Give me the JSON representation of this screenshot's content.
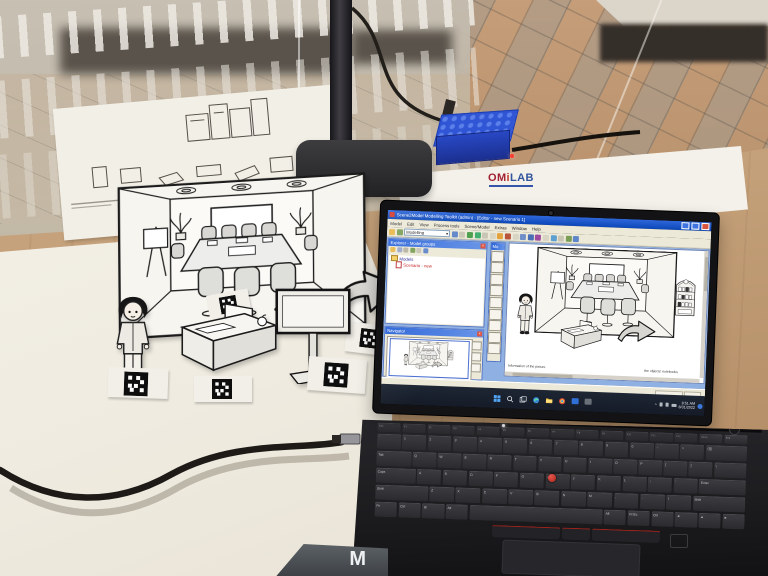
{
  "app": {
    "title": "Scene2Model Modelling Toolkit (admin) - [Editor - new Scenario 1]",
    "menus": [
      "Model",
      "Edit",
      "View",
      "Process tools",
      "Scene/Model",
      "Extras",
      "Window",
      "Help"
    ],
    "toolbar": {
      "mode_label": "Modelling",
      "mode_arrow": "▾"
    },
    "explorer": {
      "title": "Explorer - Model groups",
      "folder": "Models",
      "item": "Scenario - new",
      "close": "x"
    },
    "palette": {
      "title": "Mo"
    },
    "navigator": {
      "title": "Navigator",
      "close": "x"
    },
    "canvas": {
      "caption_left": "Information of the picture",
      "caption_right": "the objects' notebooks"
    }
  },
  "taskbar": {
    "time": "8:51 AM",
    "date": "8/31/2022"
  },
  "desk": {
    "omilab": {
      "part1": "OM",
      "part2": "i",
      "part3": "LAB"
    },
    "bottom_object_letter": "M"
  },
  "keyboard": {
    "row_fn": [
      "Esc",
      "F1",
      "F2",
      "F3",
      "F4",
      "F5",
      "F6",
      "F7",
      "F8",
      "F9",
      "F10",
      "F11",
      "F12",
      "Home",
      "End"
    ],
    "row_num": [
      "`",
      "1",
      "2",
      "3",
      "4",
      "5",
      "6",
      "7",
      "8",
      "9",
      "0",
      "-",
      "=",
      "⌫"
    ],
    "row_q": [
      "Tab",
      "Q",
      "W",
      "E",
      "R",
      "T",
      "Y",
      "U",
      "I",
      "O",
      "P",
      "[",
      "]",
      "\\"
    ],
    "row_a": [
      "Caps",
      "A",
      "S",
      "D",
      "F",
      "G",
      "H",
      "J",
      "K",
      "L",
      ";",
      "'",
      "Enter"
    ],
    "row_z": [
      "Shift",
      "Z",
      "X",
      "C",
      "V",
      "B",
      "N",
      "M",
      ",",
      ".",
      "/",
      "Shift"
    ],
    "row_space": [
      "Fn",
      "Ctrl",
      "⊞",
      "Alt",
      "",
      "Alt",
      "PrtSc",
      "Ctrl",
      "◄",
      "▲",
      "►"
    ],
    "colors": {
      "trackpoint": "#c0261b"
    }
  }
}
